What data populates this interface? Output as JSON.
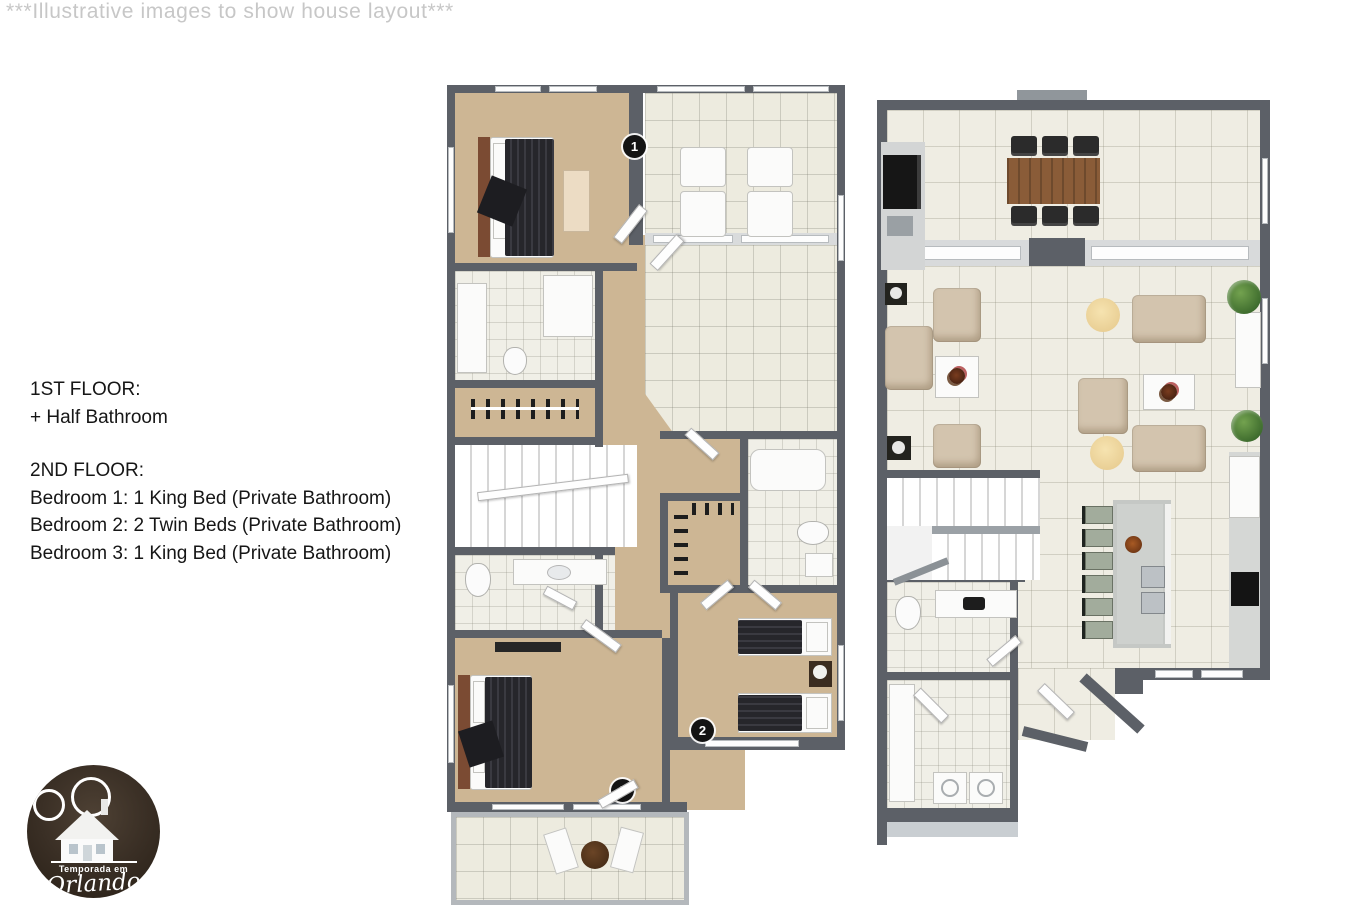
{
  "disclaimer": "***Illustrative images to show house layout***",
  "info": {
    "floor1_title": "1ST FLOOR:",
    "floor1_item": "+ Half Bathroom",
    "floor2_title": "2ND FLOOR:",
    "floor2_item1": "Bedroom 1: 1 King Bed (Private Bathroom)",
    "floor2_item2": "Bedroom 2: 2 Twin Beds (Private Bathroom)",
    "floor2_item3": "Bedroom 3: 1 King Bed (Private Bathroom)"
  },
  "markers": {
    "m1": "1",
    "m2": "2",
    "m3": "3"
  },
  "logo": {
    "top": "Temporada em",
    "name": "Orlando"
  },
  "colors": {
    "wall": "#5c6067",
    "carpet": "#cdb694",
    "tile_upstairs": "#edebdf",
    "tile_downstairs": "#efede3",
    "furniture_dark": "#26262b",
    "sofa_beige": "#d3c4ae",
    "wood_table": "#8a5c38",
    "logo_brown": "#3a2f25",
    "marker_black": "#141414",
    "disclaimer_gray": "#c7c7c7"
  }
}
